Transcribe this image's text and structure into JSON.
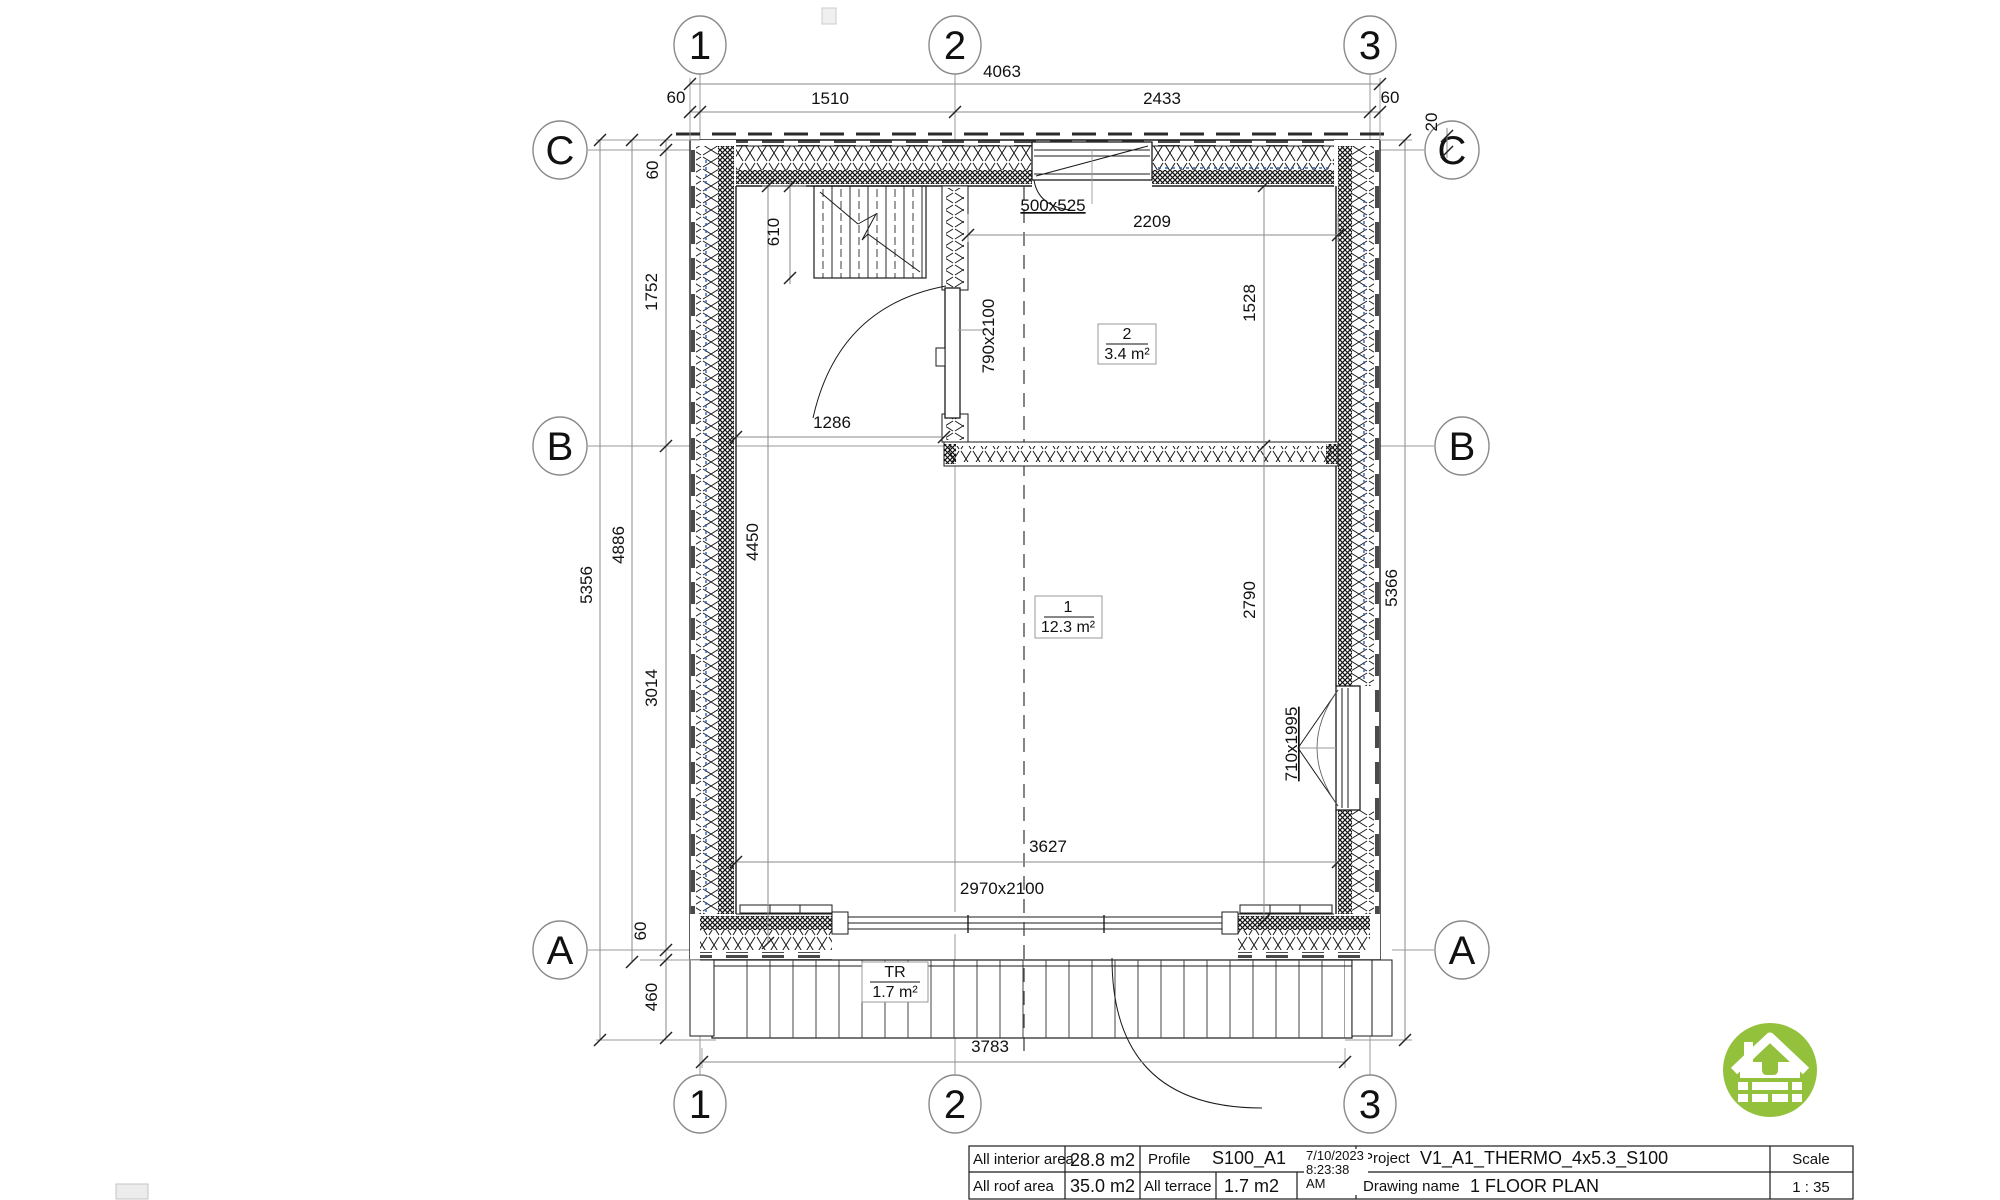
{
  "grid": {
    "col1": "1",
    "col2": "2",
    "col3": "3",
    "rowC": "C",
    "rowB": "B",
    "rowA": "A"
  },
  "dimensions": {
    "top_overall": "4063",
    "top_left_offset": "60",
    "top_span_1_2": "1510",
    "top_span_2_3": "2433",
    "top_right_offset": "60",
    "top_overhang": "20",
    "left_overall": "5356",
    "left_wall_height": "4886",
    "left_offset_top": "60",
    "left_c_to_b": "1752",
    "left_b_to_a": "3014",
    "left_offset_bottom": "60",
    "terrace_depth": "460",
    "interior_height": "4450",
    "stair_width": "610",
    "right_overall": "5366",
    "room2_height": "1528",
    "room1_height": "2790",
    "room2_width": "2209",
    "door_wall_span": "1286",
    "bottom_interior": "3627",
    "terrace_width": "3783"
  },
  "labels": {
    "window_top": "500x525",
    "door_interior": "790x2100",
    "window_right": "710x1995",
    "door_sliding": "2970x2100"
  },
  "rooms": {
    "room1": {
      "number": "1",
      "area": "12.3 m²"
    },
    "room2": {
      "number": "2",
      "area": "3.4 m²"
    },
    "terrace": {
      "number": "TR",
      "area": "1.7 m²"
    }
  },
  "title_block": {
    "interior_area_label": "All interior area",
    "interior_area_value": "28.8 m2",
    "profile_label": "Profile",
    "profile_value": "S100_A1",
    "project_label": "Project",
    "project_value": "V1_A1_THERMO_4x5.3_S100",
    "scale_label": "Scale",
    "roof_area_label": "All roof area",
    "roof_area_value": "35.0 m2",
    "terrace_label": "All terrace",
    "terrace_value": "1.7 m2",
    "date": "7/10/2023",
    "time": "8:23:38",
    "meridiem": "AM",
    "drawing_name_label": "Drawing name",
    "drawing_name_value": "1 FLOOR PLAN",
    "scale_value": "1 : 35"
  },
  "colors": {
    "logo_green": "#94c13c",
    "membrane_blue": "#2f62c1",
    "line_dark": "#1b1b1b",
    "dim_gray": "#8a8a8a"
  }
}
